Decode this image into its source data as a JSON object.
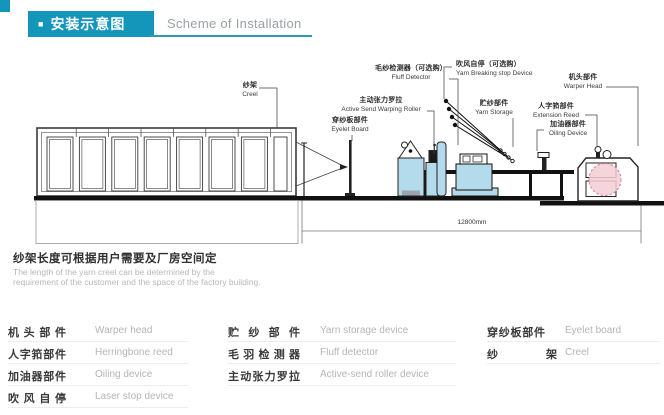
{
  "header": {
    "bullet": "■",
    "title_zh": "安装示意图",
    "title_en": "Scheme of Installation"
  },
  "diagram": {
    "labels": {
      "creel": {
        "zh": "纱架",
        "en": "Creel"
      },
      "fluff_detector": {
        "zh": "毛纱检测器（可选购）",
        "en": "Fluff Detector"
      },
      "yarn_breaking_stop": {
        "zh": "吹风自停（可选购）",
        "en": "Yarn Breaking stop Device"
      },
      "active_roller": {
        "zh": "主动张力罗拉",
        "en": "Active Send Warping Roller"
      },
      "eyelet_board": {
        "zh": "穿纱板部件",
        "en": "Eyelet Board"
      },
      "yarn_storage": {
        "zh": "贮纱部件",
        "en": "Yarn Storage"
      },
      "warper_head": {
        "zh": "机头部件",
        "en": "Warper Head"
      },
      "extension_reed": {
        "zh": "人字筘部件",
        "en": "Extension Reed"
      },
      "oiling_device": {
        "zh": "加油器部件",
        "en": "Oiling Device"
      }
    },
    "dimension_label": "12800mm"
  },
  "note": {
    "zh": "纱架长度可根据用户需要及厂房空间定",
    "en_line1": "The length of the yarn creel can be determined by the",
    "en_line2": "requirement of the customer and the space of the factory building."
  },
  "glossary": {
    "columns": [
      {
        "rows": [
          {
            "zh": "机头部件",
            "en": "Warper head"
          },
          {
            "zh": "人字筘部件",
            "en": "Herringbone reed"
          },
          {
            "zh": "加油器部件",
            "en": "Oiling device"
          },
          {
            "zh": "吹风自停",
            "en": "Laser stop device"
          }
        ]
      },
      {
        "rows": [
          {
            "zh": "贮纱部件",
            "en": "Yarn storage device"
          },
          {
            "zh": "毛羽检测器",
            "en": "Fluff detector"
          },
          {
            "zh": "主动张力罗拉",
            "en": "Active-send roller device"
          }
        ]
      },
      {
        "rows": [
          {
            "zh": "穿纱板部件",
            "en": "Eyelet board"
          },
          {
            "zh": "纱架",
            "en": "Creel"
          }
        ]
      }
    ]
  },
  "colors": {
    "accent": "#1495ba",
    "machine_fill": "#b4dbec",
    "beam_pink": "#f3cdd6"
  }
}
